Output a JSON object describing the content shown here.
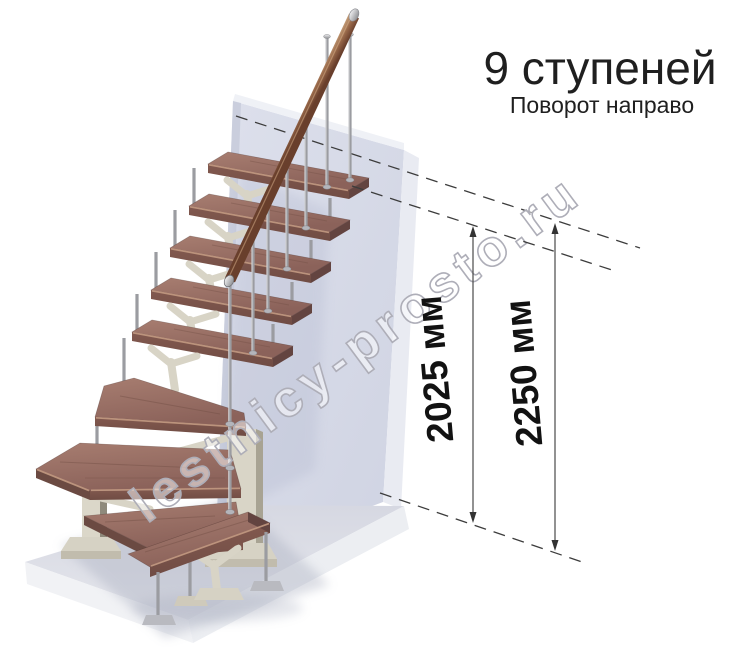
{
  "header": {
    "title": "9 ступеней",
    "subtitle": "Поворот направо"
  },
  "annotations": {
    "dim_tread_label": "2025 мм",
    "dim_total_label": "2250 мм"
  },
  "watermark": {
    "text": "lestnicy-prosto.ru"
  },
  "colors": {
    "wall": "#d6d9e6",
    "wall_edge": "#e9ebf2",
    "floor": "#e2e3e9",
    "tread_top": "#9c7065",
    "tread_front": "#7b544c",
    "nosing": "#c39a82",
    "handrail": "#8a5b40",
    "metal": "#a0a1a5",
    "support_ivory": "#d8d4c6",
    "text": "#1f1f1f",
    "watermark_outline": "#aeaeb8"
  }
}
